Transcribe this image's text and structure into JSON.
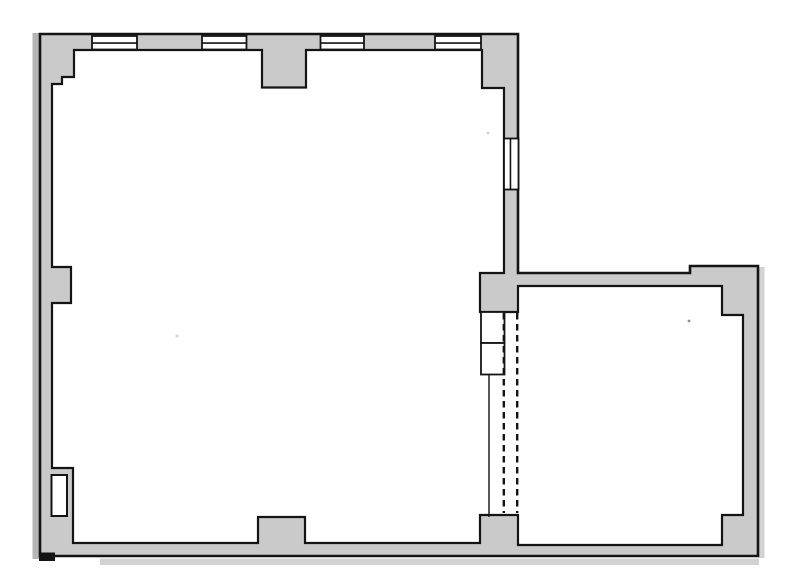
{
  "canvas": {
    "width": 787,
    "height": 588,
    "background": "#ffffff"
  },
  "colors": {
    "wall_fill": "#cacaca",
    "outline": "#141414",
    "interior_fill": "#ffffff",
    "page_shadow_dark": "#b5b5b5",
    "page_shadow_light": "#d2d2d2"
  },
  "plan": {
    "outer_wall": {
      "name": "outer-wall-outline",
      "points": [
        [
          40,
          34
        ],
        [
          518,
          34
        ],
        [
          518,
          273
        ],
        [
          690,
          273
        ],
        [
          690,
          266
        ],
        [
          758,
          266
        ],
        [
          758,
          556
        ],
        [
          40,
          556
        ]
      ],
      "stroke_width": 2.6
    },
    "interior": {
      "name": "room-interior-outline",
      "points": [
        [
          52,
          84
        ],
        [
          62,
          84
        ],
        [
          62,
          77
        ],
        [
          74,
          77
        ],
        [
          74,
          50
        ],
        [
          262,
          50
        ],
        [
          262,
          87.5
        ],
        [
          306,
          87.5
        ],
        [
          306,
          50
        ],
        [
          482,
          50
        ],
        [
          482,
          88
        ],
        [
          504,
          88
        ],
        [
          504,
          273
        ],
        [
          480,
          273
        ],
        [
          480,
          312
        ],
        [
          518,
          312
        ],
        [
          518,
          286
        ],
        [
          722,
          286
        ],
        [
          722,
          315
        ],
        [
          743,
          315
        ],
        [
          743,
          515
        ],
        [
          722,
          515
        ],
        [
          722,
          545
        ],
        [
          518,
          545
        ],
        [
          518,
          515
        ],
        [
          480,
          515
        ],
        [
          480,
          543
        ],
        [
          305,
          543
        ],
        [
          305,
          517
        ],
        [
          258,
          517
        ],
        [
          258,
          543
        ],
        [
          73,
          543
        ],
        [
          73,
          468
        ],
        [
          52,
          468
        ],
        [
          52,
          303
        ],
        [
          71,
          303
        ],
        [
          71,
          267
        ],
        [
          52,
          267
        ]
      ],
      "stroke_width": 2.2
    },
    "page_shadows": [
      {
        "name": "page-shadow-left",
        "x": 32.5,
        "y": 33,
        "w": 6.5,
        "h": 526,
        "tone": "dark"
      },
      {
        "name": "page-shadow-right",
        "x": 758.5,
        "y": 267,
        "w": 6,
        "h": 291,
        "tone": "light"
      },
      {
        "name": "page-shadow-bottom",
        "x": 100,
        "y": 558.5,
        "w": 659,
        "h": 6.5,
        "tone": "light"
      }
    ],
    "windows": [
      {
        "name": "window-top-1",
        "x": 92,
        "y": 36,
        "w": 45,
        "h": 13.5,
        "mid": "h"
      },
      {
        "name": "window-top-2",
        "x": 202,
        "y": 36,
        "w": 44.5,
        "h": 13.5,
        "mid": "h"
      },
      {
        "name": "window-top-3",
        "x": 320.5,
        "y": 36,
        "w": 43.5,
        "h": 13.5,
        "mid": "h"
      },
      {
        "name": "window-top-4",
        "x": 435,
        "y": 36,
        "w": 46,
        "h": 13.5,
        "mid": "h"
      },
      {
        "name": "window-right-wall",
        "x": 504,
        "y": 138.5,
        "w": 14.5,
        "h": 51,
        "mid": "v"
      }
    ],
    "door_niche": {
      "name": "left-wall-door-niche",
      "x": 51.5,
      "y": 475,
      "w": 15.5,
      "h": 41,
      "stroke_width": 2
    },
    "opening": {
      "boxes": [
        {
          "name": "opening-box-upper",
          "x": 481,
          "y": 312,
          "w": 23.5,
          "h": 31
        },
        {
          "name": "opening-box-lower",
          "x": 481,
          "y": 343,
          "w": 23.5,
          "h": 31.5
        }
      ],
      "edge_line": {
        "name": "opening-edge-line",
        "x": 489,
        "y1": 374.5,
        "y2": 517,
        "stroke_width": 1.4
      },
      "dashed_lines": [
        {
          "name": "opening-dashed-line-left",
          "x": 503.8,
          "y1": 313,
          "y2": 513
        },
        {
          "name": "opening-dashed-line-right",
          "x": 517.2,
          "y1": 313,
          "y2": 513
        }
      ],
      "dash_pattern": "6.5 4.5",
      "dash_stroke_width": 2.4
    },
    "corner_foot": {
      "name": "outer-corner-foot",
      "x": 39,
      "y": 552.5,
      "w": 16,
      "h": 8.5
    },
    "specks": [
      {
        "name": "scan-speck-1",
        "x": 177,
        "y": 336,
        "r": 1.6,
        "color": "#d6d6d6"
      },
      {
        "name": "scan-speck-2",
        "x": 488,
        "y": 133,
        "r": 1.2,
        "color": "#c9c9c9"
      },
      {
        "name": "scan-speck-3",
        "x": 689,
        "y": 321,
        "r": 1.4,
        "color": "#8f8f8f"
      }
    ]
  }
}
